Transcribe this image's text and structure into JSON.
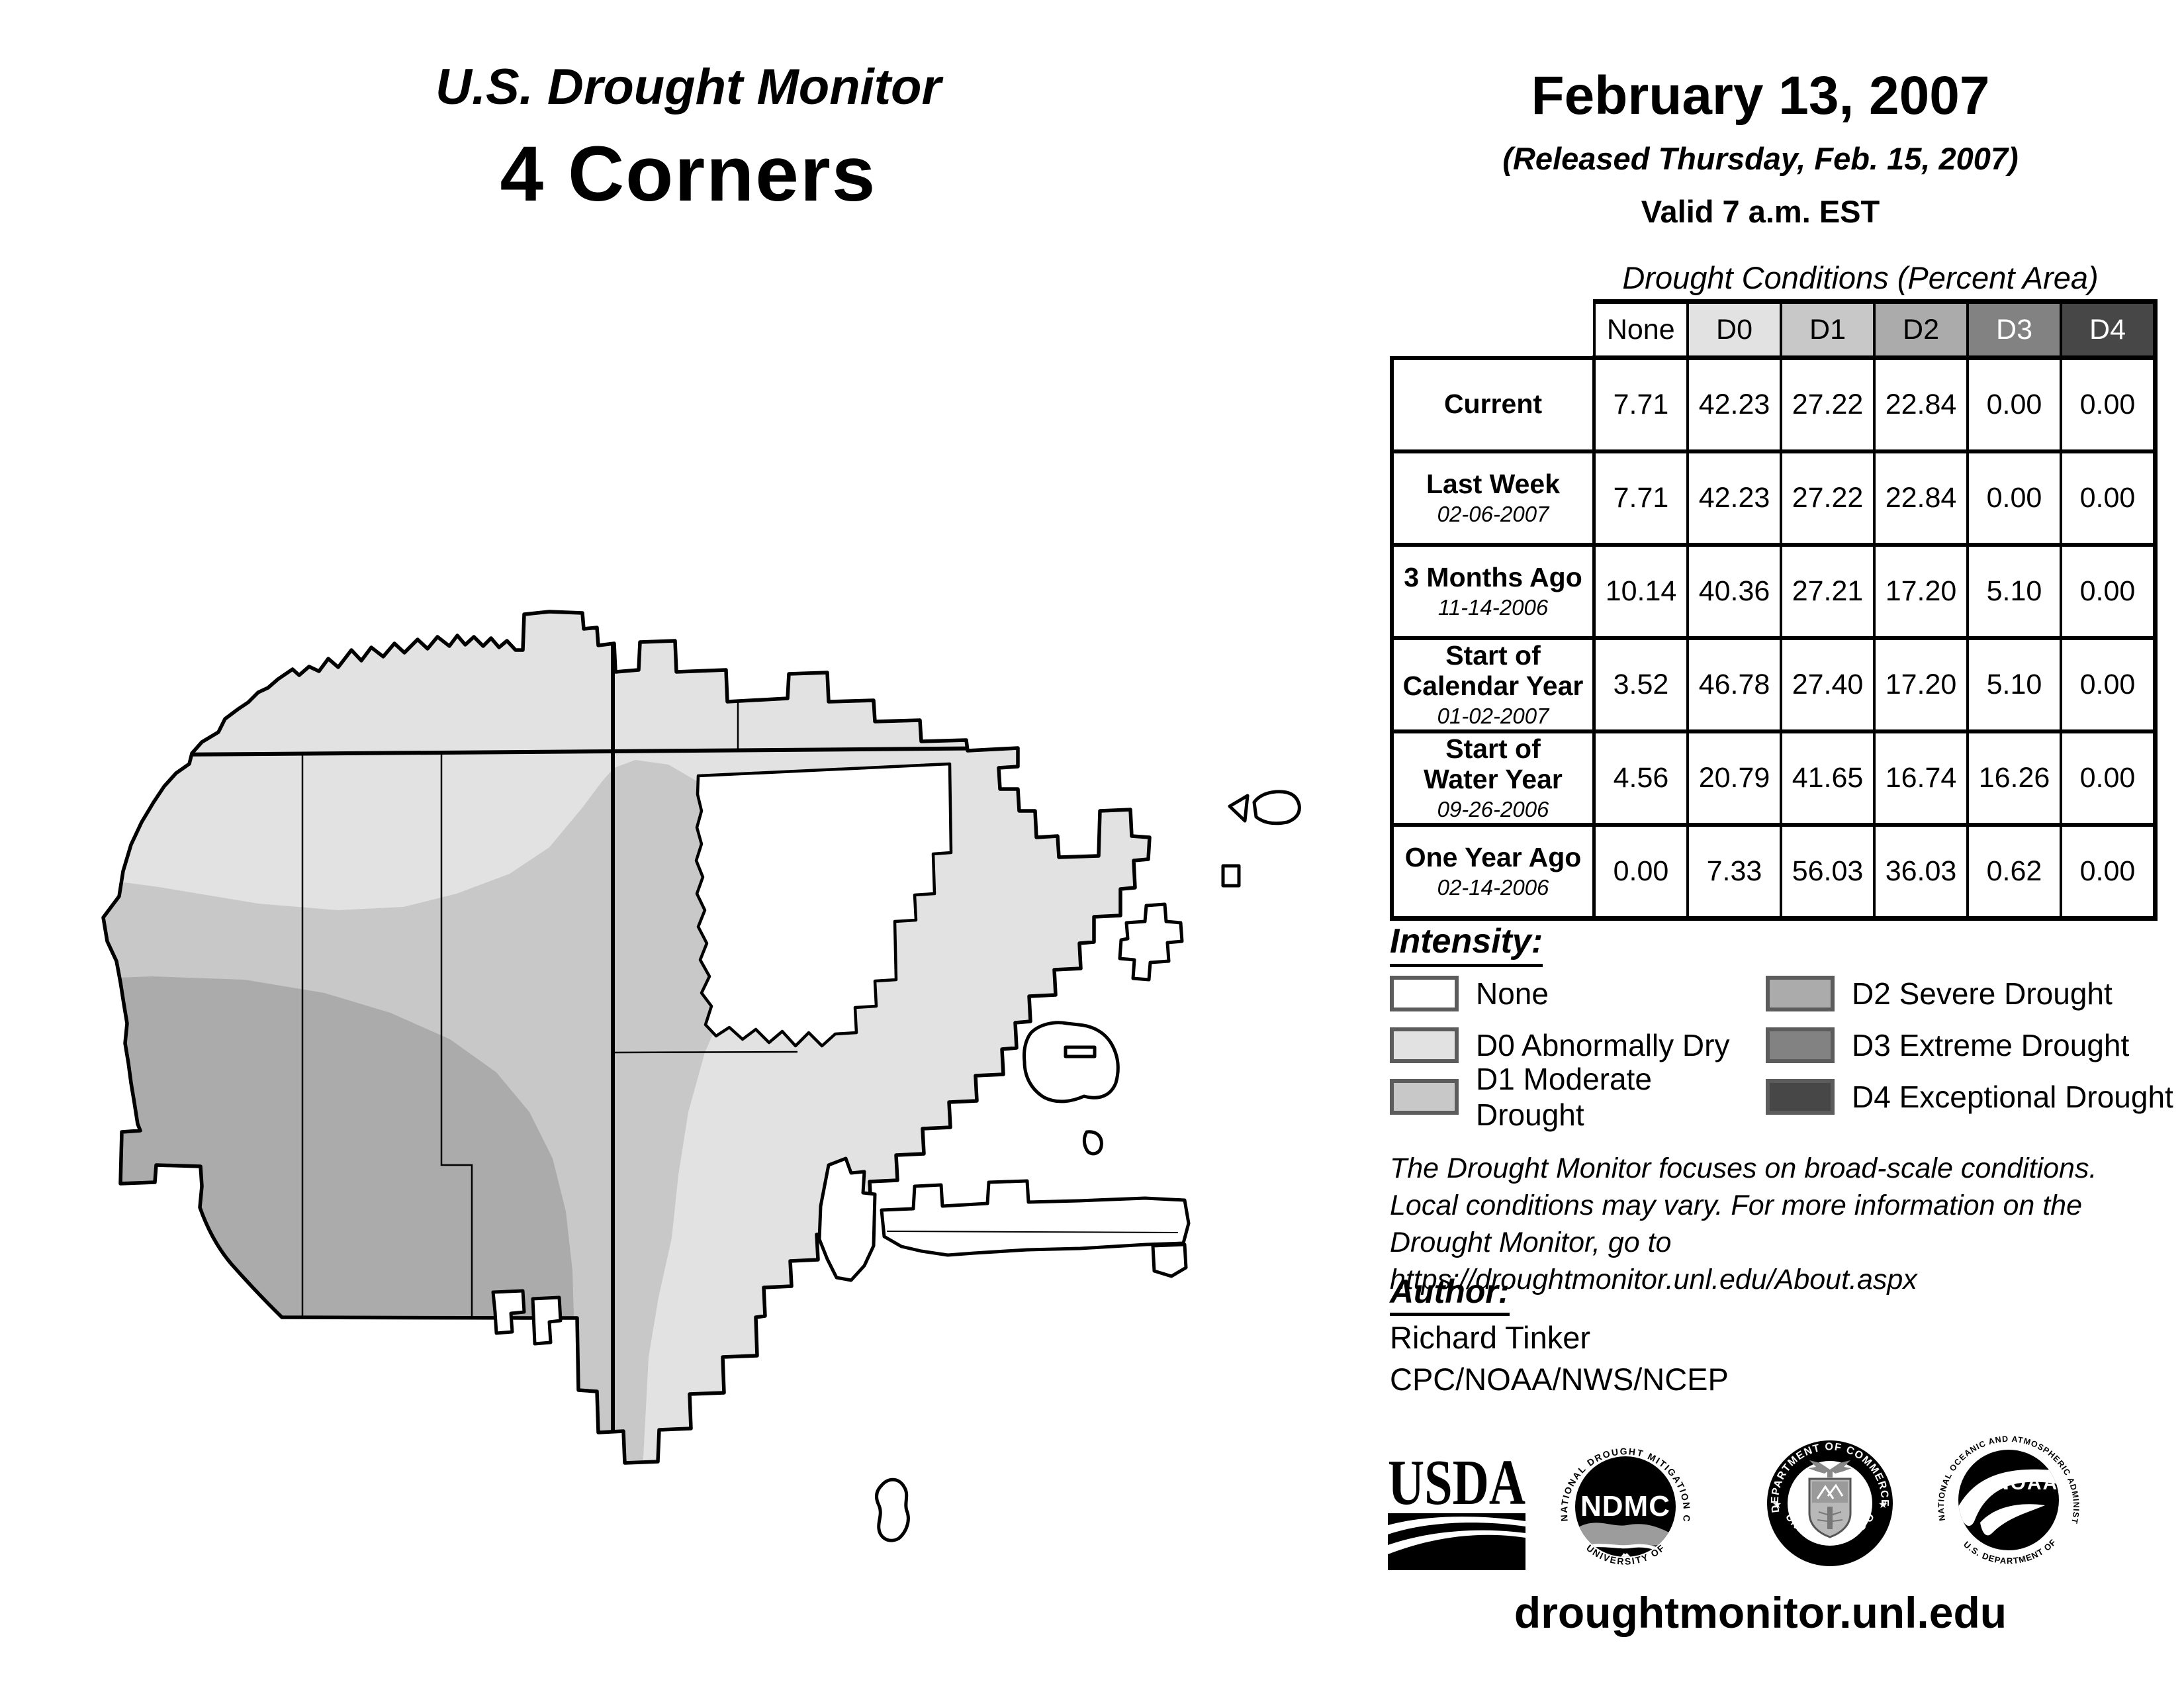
{
  "header": {
    "title": "U.S. Drought Monitor",
    "region": "4 Corners",
    "date": "February 13, 2007",
    "released": "(Released Thursday, Feb. 15, 2007)",
    "valid": "Valid 7 a.m. EST"
  },
  "table": {
    "title": "Drought Conditions (Percent Area)",
    "columns": [
      "None",
      "D0",
      "D1",
      "D2",
      "D3",
      "D4"
    ],
    "rows": [
      {
        "label": "Current",
        "sublabel": "",
        "values": [
          "7.71",
          "42.23",
          "27.22",
          "22.84",
          "0.00",
          "0.00"
        ]
      },
      {
        "label": "Last Week",
        "sublabel": "02-06-2007",
        "values": [
          "7.71",
          "42.23",
          "27.22",
          "22.84",
          "0.00",
          "0.00"
        ]
      },
      {
        "label": "3 Months Ago",
        "sublabel": "11-14-2006",
        "values": [
          "10.14",
          "40.36",
          "27.21",
          "17.20",
          "5.10",
          "0.00"
        ]
      },
      {
        "label": "Start of\nCalendar Year",
        "sublabel": "01-02-2007",
        "values": [
          "3.52",
          "46.78",
          "27.40",
          "17.20",
          "5.10",
          "0.00"
        ]
      },
      {
        "label": "Start of\nWater Year",
        "sublabel": "09-26-2006",
        "values": [
          "4.56",
          "20.79",
          "41.65",
          "16.74",
          "16.26",
          "0.00"
        ]
      },
      {
        "label": "One Year Ago",
        "sublabel": "02-14-2006",
        "values": [
          "0.00",
          "7.33",
          "56.03",
          "36.03",
          "0.62",
          "0.00"
        ]
      }
    ]
  },
  "legend": {
    "title": "Intensity:",
    "items": [
      {
        "code": "None",
        "label": "None",
        "color": "#ffffff"
      },
      {
        "code": "D0",
        "label": "D0 Abnormally Dry",
        "color": "#e2e2e2"
      },
      {
        "code": "D1",
        "label": "D1 Moderate Drought",
        "color": "#c8c8c8"
      },
      {
        "code": "D2",
        "label": "D2 Severe Drought",
        "color": "#ababab"
      },
      {
        "code": "D3",
        "label": "D3 Extreme Drought",
        "color": "#828282"
      },
      {
        "code": "D4",
        "label": "D4 Exceptional Drought",
        "color": "#474747"
      }
    ],
    "white_text_codes": [
      "D3",
      "D4"
    ]
  },
  "disclaimer": "The Drought Monitor focuses on broad-scale conditions.\nLocal conditions may vary. For more information on the\nDrought Monitor, go to https://droughtmonitor.unl.edu/About.aspx",
  "author": {
    "heading": "Author:",
    "name": "Richard Tinker",
    "org": "CPC/NOAA/NWS/NCEP"
  },
  "logos": {
    "usda": {
      "word": "USDA"
    },
    "ndmc": {
      "top": "NATIONAL DROUGHT MITIGATION CENTER",
      "center": "NDMC",
      "bottom": "UNIVERSITY OF NEBRASKA"
    },
    "doc": {
      "top": "DEPARTMENT OF COMMERCE",
      "bottom": "UNITED STATES OF AMERICA"
    },
    "noaa": {
      "top": "NATIONAL OCEANIC AND ATMOSPHERIC ADMINISTRATION",
      "center": "NOAA",
      "bottom": "U.S. DEPARTMENT OF COMMERCE"
    }
  },
  "footer": {
    "url": "droughtmonitor.unl.edu"
  }
}
